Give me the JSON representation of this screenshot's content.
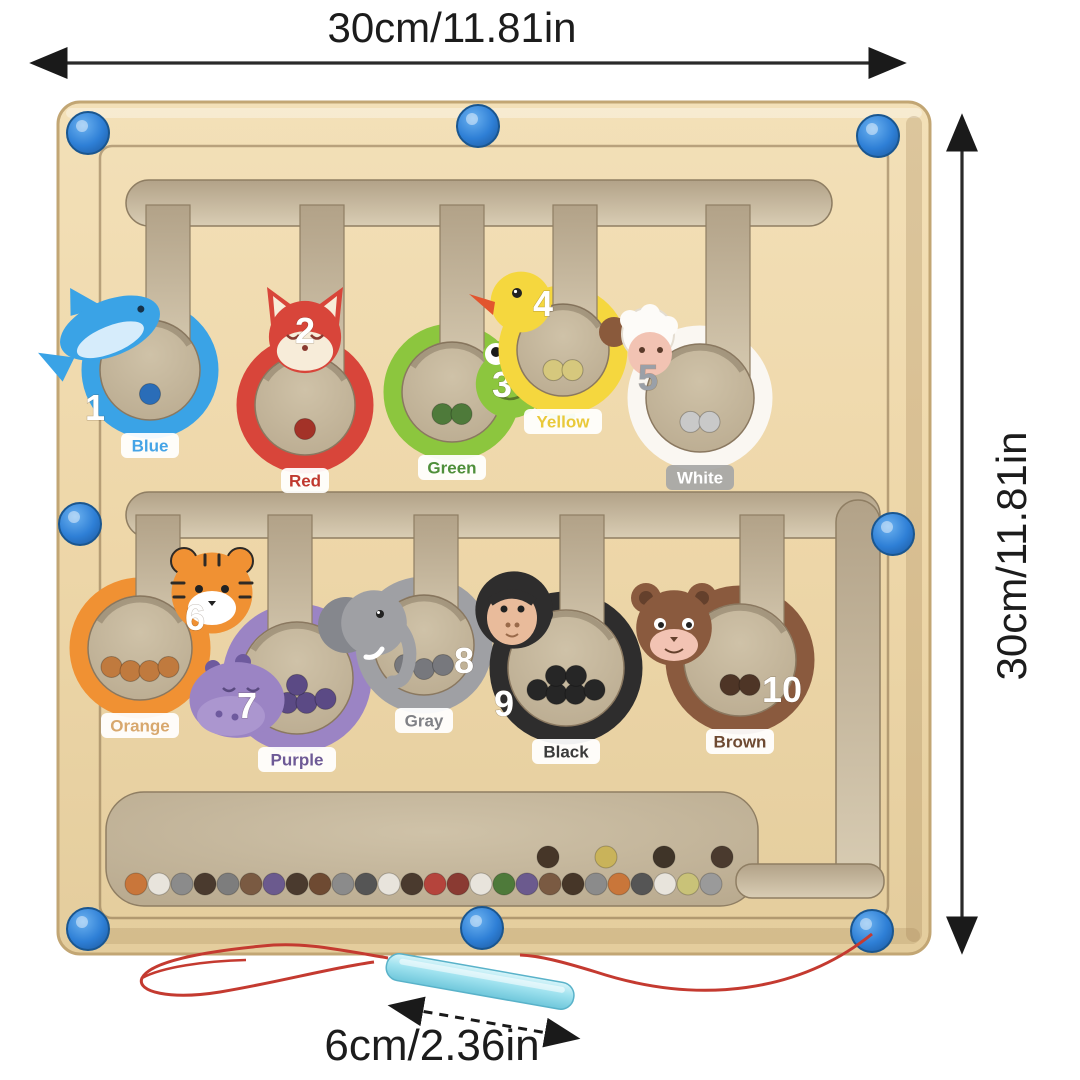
{
  "product": {
    "type": "magnetic color and number maze board",
    "annotations": {
      "top_width": "30cm/11.81in",
      "right_height": "30cm/11.81in",
      "pen_length": "6cm/2.36in"
    }
  },
  "board": {
    "base_color": "#eed7a9",
    "edge_color": "#c2a674",
    "groove_color": "#8d7a5c",
    "channel_color": "#c6b79c",
    "channel_edge": "#8f7e63",
    "peg_color": "#2e7fd6",
    "peg_count": 8
  },
  "stations": [
    {
      "number": "1",
      "name": "Blue",
      "species": "dolphin",
      "body": "#3aa3e6",
      "accent": "#1d79c0",
      "face": "#d6ecfb",
      "ball": "#2a6db8",
      "ball_count": 1,
      "label_color": "#45a4e6",
      "label_bg": "#ffffff",
      "number_color": "#ffffff"
    },
    {
      "number": "2",
      "name": "Red",
      "species": "fox",
      "body": "#d8453a",
      "accent": "#b02c24",
      "face": "#f7ecd9",
      "ball": "#a33228",
      "ball_count": 1,
      "label_color": "#c0392f",
      "label_bg": "#ffffff",
      "number_color": "#ffffff"
    },
    {
      "number": "3",
      "name": "Green",
      "species": "frog",
      "body": "#8cc63e",
      "accent": "#5f8f2e",
      "face": "#ffffff",
      "ball": "#4e7a3a",
      "ball_count": 2,
      "label_color": "#4f8f3a",
      "label_bg": "#ffffff",
      "number_color": "#ffffff"
    },
    {
      "number": "4",
      "name": "Yellow",
      "species": "duck",
      "body": "#f5d73e",
      "accent": "#e2552e",
      "face": "#ffffff",
      "ball": "#d6c87d",
      "ball_count": 2,
      "label_color": "#e9c93a",
      "label_bg": "#ffffff",
      "number_color": "#ffffff"
    },
    {
      "number": "5",
      "name": "White",
      "species": "sheep",
      "body": "#faf7f2",
      "accent": "#8a5a3c",
      "face": "#f2c3b3",
      "ball": "#c9c9c9",
      "ball_count": 2,
      "label_color": "#ffffff",
      "label_bg": "#a7a7a7",
      "number_color": "#9aa0a8"
    },
    {
      "number": "6",
      "name": "Orange",
      "species": "tiger",
      "body": "#f09133",
      "accent": "#2e2a26",
      "face": "#ffffff",
      "ball": "#c07a3e",
      "ball_count": 4,
      "label_color": "#d8a86e",
      "label_bg": "#ffffff",
      "number_color": "#ffffff"
    },
    {
      "number": "7",
      "name": "Purple",
      "species": "hippo",
      "body": "#9b84c4",
      "accent": "#6e5a9e",
      "face": "#ab96cf",
      "ball": "#5b4a85",
      "ball_count": 5,
      "label_color": "#6e5a96",
      "label_bg": "#ffffff",
      "number_color": "#ffffff"
    },
    {
      "number": "8",
      "name": "Gray",
      "species": "elephant",
      "body": "#9fa0a4",
      "accent": "#85878d",
      "face": "#ffffff",
      "ball": "#77787d",
      "ball_count": 3,
      "label_color": "#808186",
      "label_bg": "#ffffff",
      "number_color": "#ffffff"
    },
    {
      "number": "9",
      "name": "Black",
      "species": "gorilla",
      "body": "#2e2d2d",
      "accent": "#1b1b1b",
      "face": "#e9bb9b",
      "ball": "#262626",
      "ball_count": 6,
      "label_color": "#3a3a3a",
      "label_bg": "#ffffff",
      "number_color": "#ffffff"
    },
    {
      "number": "10",
      "name": "Brown",
      "species": "bear",
      "body": "#8a5a3e",
      "accent": "#64402c",
      "face": "#f2c3b3",
      "ball": "#4e3526",
      "ball_count": 2,
      "label_color": "#6e4a32",
      "label_bg": "#ffffff",
      "number_color": "#ffffff"
    }
  ],
  "trough": {
    "bottom_row": [
      "#c9763a",
      "#e8e4dc",
      "#8b8b8b",
      "#4a3a2e",
      "#7d7d7d",
      "#7a5a42",
      "#6b5a8e",
      "#4a3a2e",
      "#6e4a32",
      "#8b8b8b",
      "#555555",
      "#e8e4dc",
      "#4a3a2e",
      "#b5443c",
      "#8a3a32",
      "#e8e4dc",
      "#4e7a3a",
      "#6b5a8e",
      "#7a5a42",
      "#463628",
      "#8b8b8b",
      "#c9763a",
      "#555555",
      "#e8e4dc",
      "#c9c278",
      "#9a9a9a"
    ],
    "raised": [
      "#463628",
      "#c9b35a",
      "#3f3428",
      "#4a3a2e"
    ]
  },
  "pen": {
    "color": "#9fe2ef",
    "edge_color": "#59b2c9",
    "string_color": "#c43a30"
  }
}
